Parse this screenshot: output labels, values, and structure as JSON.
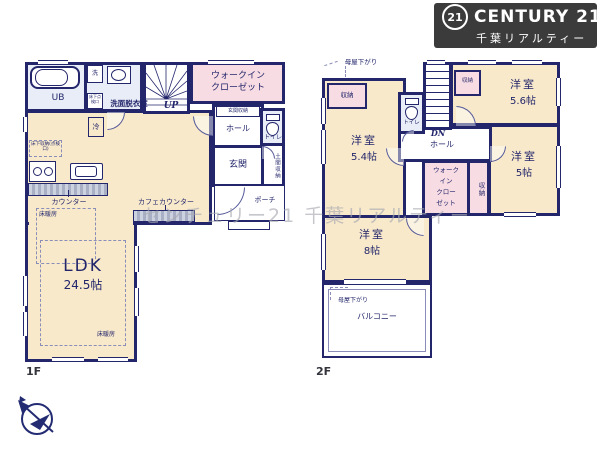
{
  "brand": {
    "circle": "21",
    "name": "CENTURY 21",
    "subtitle": "千葉リアルティー"
  },
  "watermark": "センチュリー21 千葉リアルティー",
  "colors": {
    "wall": "#23266b",
    "room_fill": "#f8e9cb",
    "closet_fill": "#f8dce3",
    "sanitary_fill": "#e9edf7",
    "logo_bg": "#3b3b3b",
    "watermark_text": "#a9aab2"
  },
  "floor1": {
    "label": "1F",
    "bath": {
      "ub": "UB",
      "washer": "洗",
      "hatch": "床下点検口",
      "washroom": "洗面脱衣室"
    },
    "kitchen": {
      "fridge": "冷",
      "underfloor_storage": "床下収納(点検口)",
      "counter": "カウンター",
      "cafe_counter": "カフェカウンター",
      "floor_heating": "床暖房"
    },
    "ldk": {
      "name": "LDK",
      "size": "24.5帖",
      "floor_heating": "床暖房"
    },
    "stairs": "UP",
    "wic": {
      "line1": "ウォークイン",
      "line2": "クローゼット"
    },
    "entry": {
      "entrance_storage": "玄関収納",
      "hall": "ホール",
      "toilet": "トイレ",
      "entrance": "玄関",
      "doma_storage": "土間収納",
      "porch": "ポーチ"
    }
  },
  "floor2": {
    "label": "2F",
    "annotations": {
      "moya_top": "母屋下がり",
      "moya_bottom": "母屋下がり"
    },
    "room54": {
      "name": "洋室",
      "size": "5.4帖",
      "storage": "収納"
    },
    "room56": {
      "name": "洋室",
      "size": "5.6帖",
      "storage": "収納"
    },
    "room5": {
      "name": "洋室",
      "size": "5帖"
    },
    "room8": {
      "name": "洋室",
      "size": "8帖"
    },
    "wic": [
      "ウォーク",
      "イン",
      "クロー",
      "ゼット"
    ],
    "storage": "収納",
    "hall": "ホール",
    "toilet": "トイレ",
    "stairs": "DN",
    "balcony": "バルコニー"
  }
}
